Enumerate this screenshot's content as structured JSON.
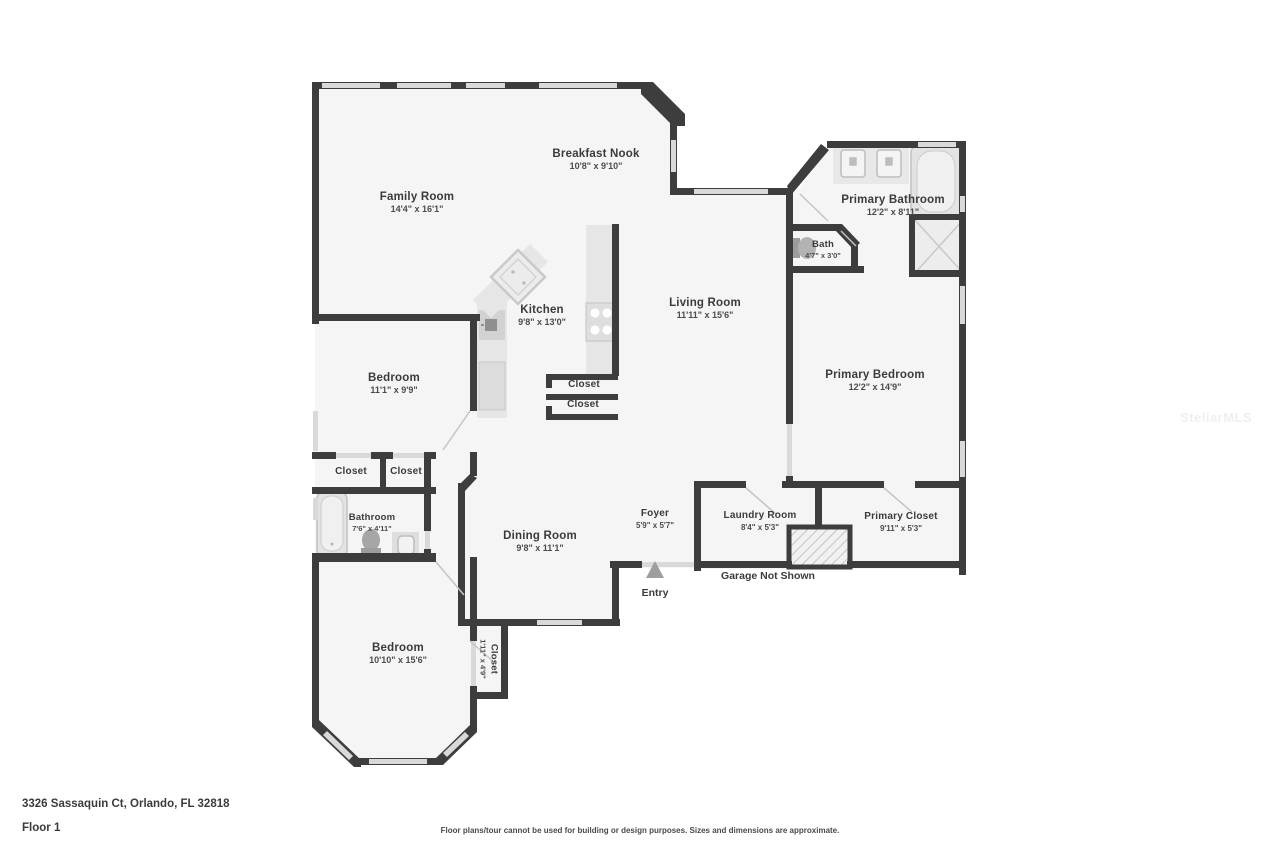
{
  "address": "3326 Sassaquin Ct, Orlando, FL 32818",
  "floor_label": "Floor 1",
  "disclaimer": "Floor plans/tour cannot be used for building or design purposes. Sizes and dimensions are approximate.",
  "watermark": "StellarMLS",
  "colors": {
    "wall": "#3d3d3d",
    "window": "#d9d9d9",
    "room_fill": "#f5f5f5",
    "fixture_fill": "#e6e6e6",
    "fixture_stroke": "#c9c9c9",
    "door_swing": "#c4c4c4"
  },
  "rooms": {
    "family_room": {
      "name": "Family Room",
      "dims": "14'4\" x 16'1\""
    },
    "breakfast_nook": {
      "name": "Breakfast Nook",
      "dims": "10'8\" x 9'10\""
    },
    "primary_bathroom": {
      "name": "Primary Bathroom",
      "dims": "12'2\" x 8'11\""
    },
    "bath": {
      "name": "Bath",
      "dims": "4'7\" x 3'0\""
    },
    "kitchen": {
      "name": "Kitchen",
      "dims": "9'8\" x 13'0\""
    },
    "living_room": {
      "name": "Living Room",
      "dims": "11'11\" x 15'6\""
    },
    "bedroom_mid": {
      "name": "Bedroom",
      "dims": "11'1\" x 9'9\""
    },
    "primary_bedroom": {
      "name": "Primary Bedroom",
      "dims": "12'2\" x 14'9\""
    },
    "closet_a": {
      "name": "Closet"
    },
    "closet_b": {
      "name": "Closet"
    },
    "closet_k1": {
      "name": "Closet"
    },
    "closet_k2": {
      "name": "Closet"
    },
    "bathroom": {
      "name": "Bathroom",
      "dims": "7'6\" x 4'11\""
    },
    "dining_room": {
      "name": "Dining Room",
      "dims": "9'8\" x 11'1\""
    },
    "foyer": {
      "name": "Foyer",
      "dims": "5'9\" x 5'7\""
    },
    "laundry_room": {
      "name": "Laundry Room",
      "dims": "8'4\" x 5'3\""
    },
    "primary_closet": {
      "name": "Primary Closet",
      "dims": "9'11\" x 5'3\""
    },
    "bedroom_bottom": {
      "name": "Bedroom",
      "dims": "10'10\" x 15'6\""
    },
    "closet_vertical": {
      "name": "Closet",
      "dims": "1'11\" x 4'9\""
    }
  },
  "annotations": {
    "garage_note": "Garage Not Shown",
    "entry": "Entry"
  }
}
